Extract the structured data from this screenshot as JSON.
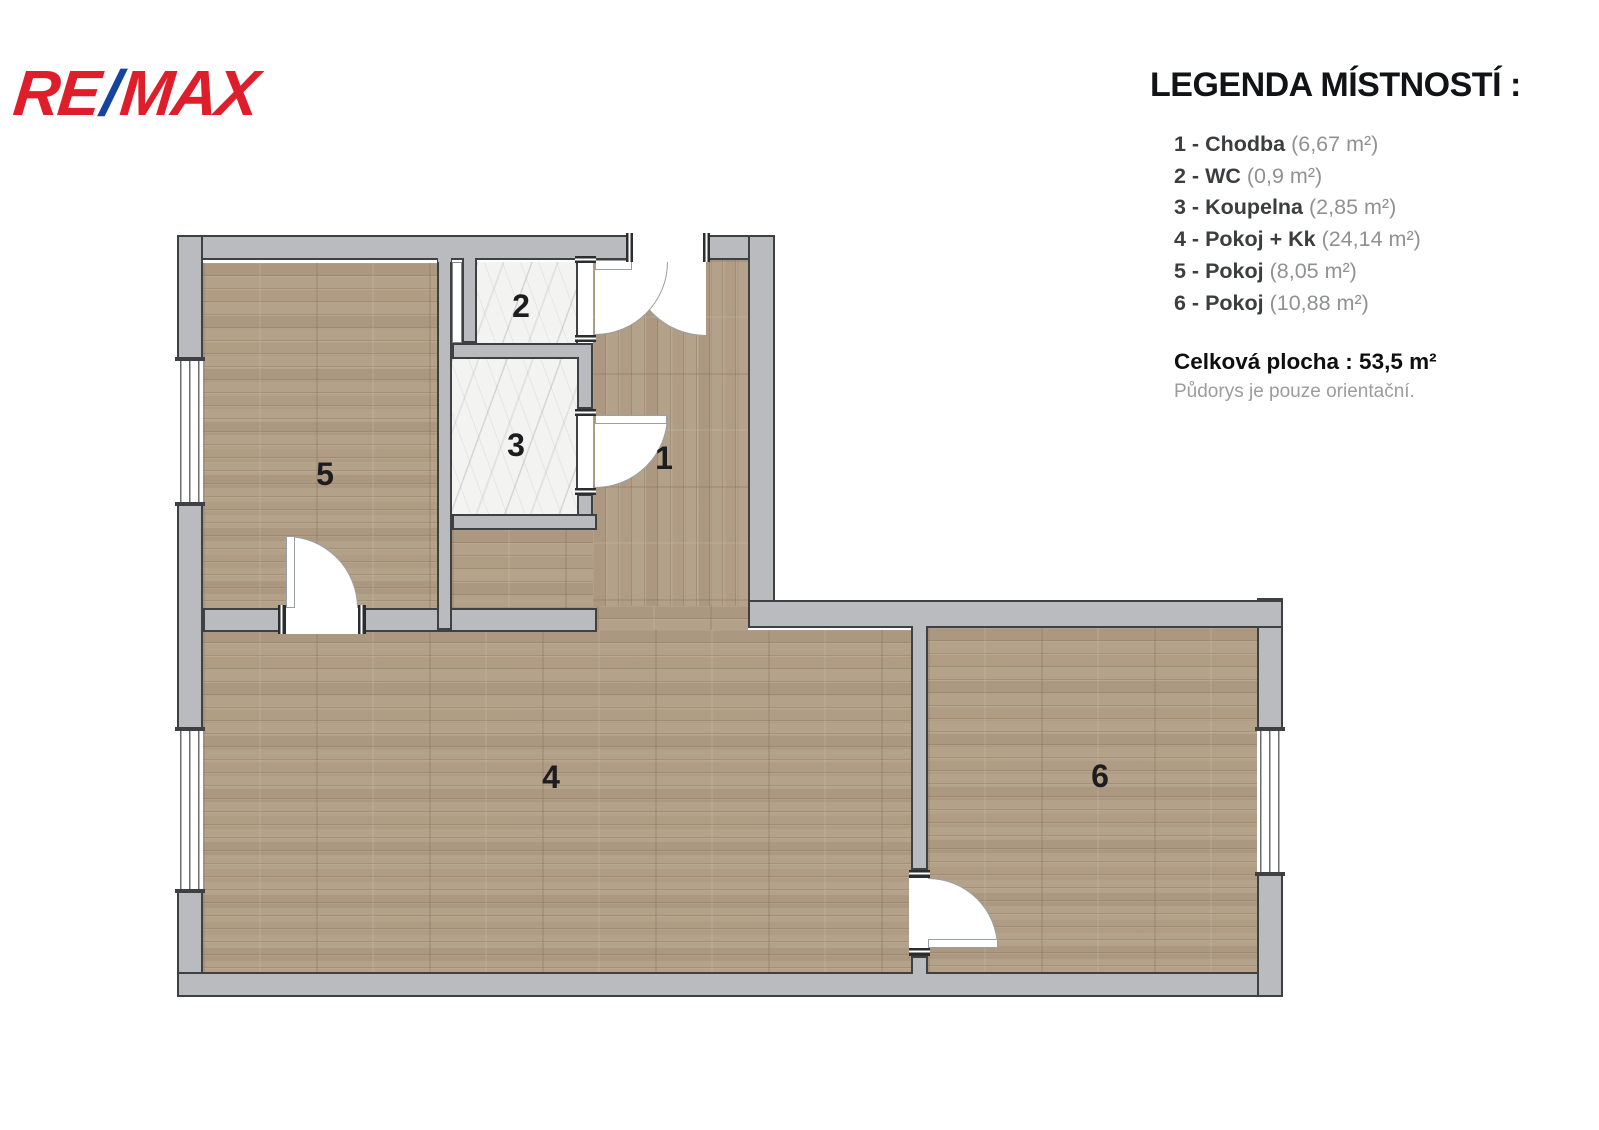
{
  "logo": {
    "re": "RE",
    "slash": "/",
    "max": "MAX"
  },
  "legend": {
    "title": "LEGENDA MÍSTNOSTÍ :",
    "items": [
      {
        "label": "1 - Chodba",
        "area": "(6,67 m²)"
      },
      {
        "label": "2 - WC",
        "area": "(0,9 m²)"
      },
      {
        "label": "3 - Koupelna",
        "area": "(2,85 m²)"
      },
      {
        "label": "4 - Pokoj + Kk",
        "area": "(24,14 m²)"
      },
      {
        "label": "5 - Pokoj",
        "area": "(8,05 m²)"
      },
      {
        "label": "6 - Pokoj",
        "area": "(10,88 m²)"
      }
    ],
    "total": "Celková plocha : 53,5 m²",
    "disclaimer": "Půdorys je pouze orientační."
  },
  "plan": {
    "room_numbers": {
      "r1": "1",
      "r2": "2",
      "r3": "3",
      "r4": "4",
      "r5": "5",
      "r6": "6"
    }
  },
  "colors": {
    "brand_red": "#DE1F2B",
    "brand_blue": "#15449F",
    "wall_gray": "#b9bbbe",
    "wall_outline": "#3f4042",
    "floor_wood": "#b19e86",
    "floor_marble": "#f3f3f2"
  }
}
